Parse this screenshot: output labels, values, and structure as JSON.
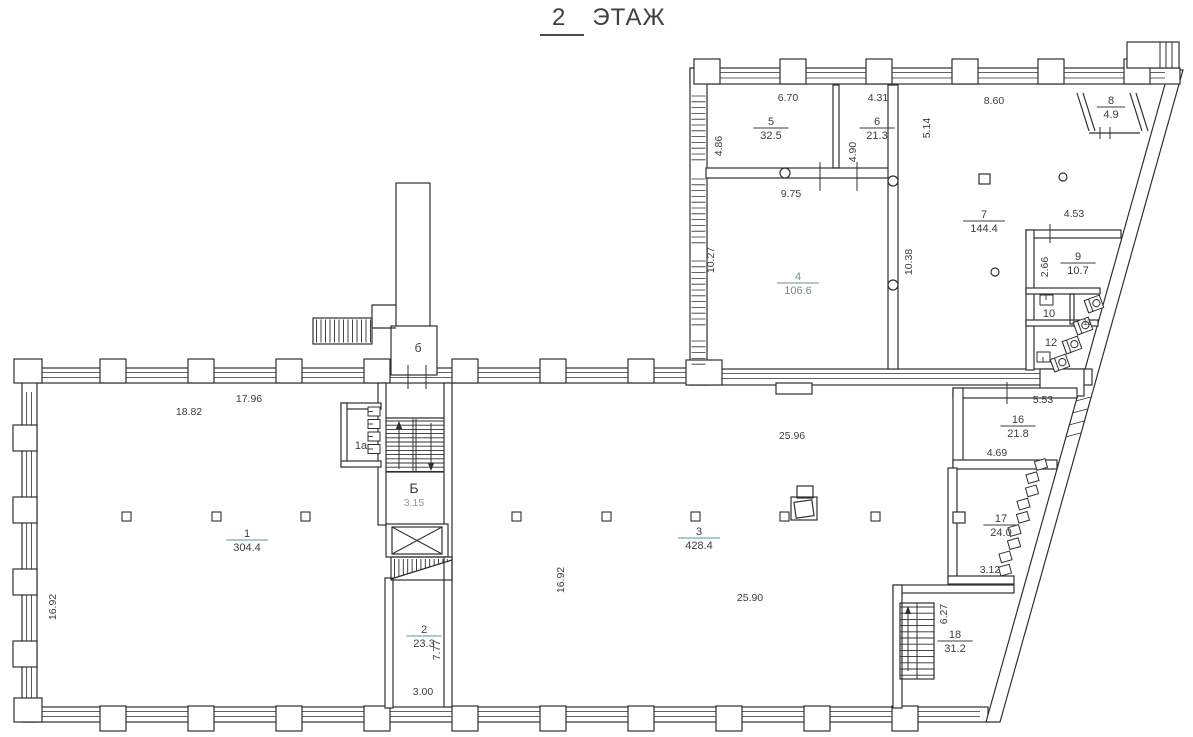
{
  "title": {
    "number": "2",
    "word": "ЭТАЖ"
  },
  "floor_plan": {
    "rooms": [
      {
        "number": "1",
        "area": "304.4",
        "x": 247,
        "y": 540,
        "color": "#3c3c3c",
        "line_color": "#4f9a97"
      },
      {
        "number": "2",
        "area": "23.3",
        "x": 424,
        "y": 636,
        "color": "#3c3c3c",
        "line_color": "#4f9a97"
      },
      {
        "number": "3",
        "area": "428.4",
        "x": 699,
        "y": 538,
        "color": "#3c3c3c",
        "line_color": "#4f9a97"
      },
      {
        "number": "4",
        "area": "106.6",
        "x": 798,
        "y": 283,
        "color": "#6d8f8c",
        "line_color": "#6d8f8c"
      },
      {
        "number": "5",
        "area": "32.5",
        "x": 771,
        "y": 128,
        "color": "#3c3c3c",
        "line_color": "#3c3c3c"
      },
      {
        "number": "6",
        "area": "21.3",
        "x": 877,
        "y": 128,
        "color": "#3c3c3c",
        "line_color": "#3c3c3c"
      },
      {
        "number": "7",
        "area": "144.4",
        "x": 984,
        "y": 221,
        "color": "#3c3c3c",
        "line_color": "#3c3c3c"
      },
      {
        "number": "8",
        "area": "4.9",
        "x": 1111,
        "y": 107,
        "color": "#3c3c3c",
        "line_color": "#3c3c3c"
      },
      {
        "number": "9",
        "area": "10.7",
        "x": 1078,
        "y": 263,
        "color": "#3c3c3c",
        "line_color": "#3c3c3c"
      },
      {
        "number": "16",
        "area": "21.8",
        "x": 1018,
        "y": 426,
        "color": "#3c3c3c",
        "line_color": "#3c3c3c"
      },
      {
        "number": "17",
        "area": "24.0",
        "x": 1001,
        "y": 525,
        "color": "#3c3c3c",
        "line_color": "#3c3c3c"
      },
      {
        "number": "18",
        "area": "31.2",
        "x": 955,
        "y": 641,
        "color": "#3c3c3c",
        "line_color": "#3c3c3c"
      }
    ],
    "zone_labels": [
      {
        "text": "1а",
        "x": 361,
        "y": 449,
        "size": 11
      },
      {
        "text": "Б",
        "x": 414,
        "y": 493,
        "size": 14
      },
      {
        "text": "б",
        "x": 418,
        "y": 352,
        "size": 12
      },
      {
        "text": "10",
        "x": 1049,
        "y": 317,
        "size": 11
      },
      {
        "text": "11",
        "x": 1087,
        "y": 325,
        "size": 8
      },
      {
        "text": "12",
        "x": 1051,
        "y": 346,
        "size": 11
      }
    ],
    "dimensions": [
      {
        "text": "6.70",
        "x": 788,
        "y": 101
      },
      {
        "text": "4.31",
        "x": 878,
        "y": 101
      },
      {
        "text": "8.60",
        "x": 994,
        "y": 104
      },
      {
        "text": "4.86",
        "x": 722,
        "y": 146,
        "rotate": -90
      },
      {
        "text": "4.90",
        "x": 856,
        "y": 152,
        "rotate": -90
      },
      {
        "text": "5.14",
        "x": 930,
        "y": 128,
        "rotate": -90
      },
      {
        "text": "9.75",
        "x": 791,
        "y": 197
      },
      {
        "text": "10.27",
        "x": 714,
        "y": 260,
        "rotate": -90
      },
      {
        "text": "10.38",
        "x": 912,
        "y": 262,
        "rotate": -90
      },
      {
        "text": "4.53",
        "x": 1074,
        "y": 217
      },
      {
        "text": "2.66",
        "x": 1048,
        "y": 267,
        "rotate": -90
      },
      {
        "text": "17.96",
        "x": 249,
        "y": 402
      },
      {
        "text": "18.82",
        "x": 189,
        "y": 415
      },
      {
        "text": "16.92",
        "x": 56,
        "y": 607,
        "rotate": -90
      },
      {
        "text": "25.96",
        "x": 792,
        "y": 439
      },
      {
        "text": "16.92",
        "x": 564,
        "y": 580,
        "rotate": -90
      },
      {
        "text": "25.90",
        "x": 750,
        "y": 601
      },
      {
        "text": "5.53",
        "x": 1043,
        "y": 403
      },
      {
        "text": "4.69",
        "x": 997,
        "y": 456
      },
      {
        "text": "3.12",
        "x": 990,
        "y": 573
      },
      {
        "text": "6.27",
        "x": 947,
        "y": 614,
        "rotate": -90
      },
      {
        "text": "3.00",
        "x": 423,
        "y": 695
      },
      {
        "text": "7.77",
        "x": 440,
        "y": 650,
        "rotate": -90
      },
      {
        "text": "3.15",
        "x": 414,
        "y": 506,
        "color": "#8d9b99"
      }
    ]
  }
}
